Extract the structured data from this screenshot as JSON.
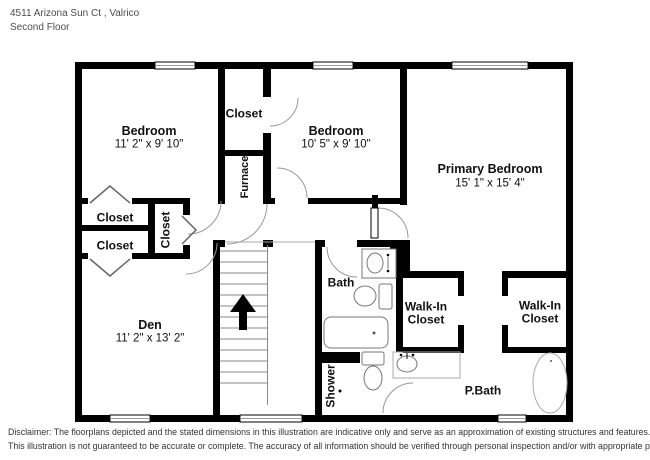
{
  "header": {
    "address": "4511 Arizona Sun Ct , Valrico",
    "floor": "Second Floor"
  },
  "rooms": {
    "bedroom1": {
      "name": "Bedroom",
      "dims": "11' 2\" x 9' 10\""
    },
    "bedroom2": {
      "name": "Bedroom",
      "dims": "10' 5\" x 9' 10\""
    },
    "primary_bedroom": {
      "name": "Primary Bedroom",
      "dims": "15' 1\" x 15' 4\""
    },
    "den": {
      "name": "Den",
      "dims": "11' 2\" x 13' 2\""
    },
    "closet_top": {
      "name": "Closet"
    },
    "closet_left_upper": {
      "name": "Closet"
    },
    "closet_left_lower": {
      "name": "Closet"
    },
    "closet_hall": {
      "name": "Closet"
    },
    "furnace": {
      "name": "Furnace"
    },
    "bath": {
      "name": "Bath"
    },
    "shower": {
      "name": "Shower"
    },
    "walk_in_closet_left": {
      "name": "Walk-In Closet"
    },
    "walk_in_closet_right": {
      "name": "Walk-In Closet"
    },
    "primary_bath": {
      "name": "P.Bath"
    }
  },
  "disclaimer": {
    "line1": "Disclaimer: The floorplans depicted and the stated dimensions in this illustration are indicative only and serve as an approximation of existing structures and features.",
    "line2": "This illustration is not guaranteed to be accurate or complete. The accuracy of all information should be verified through personal inspection and/or with appropriate professionals."
  },
  "colors": {
    "wall": "#000000",
    "door_arc": "#999999",
    "fixture": "#777777",
    "header_text": "#4d4d4d",
    "disclaimer_text": "#333333"
  }
}
